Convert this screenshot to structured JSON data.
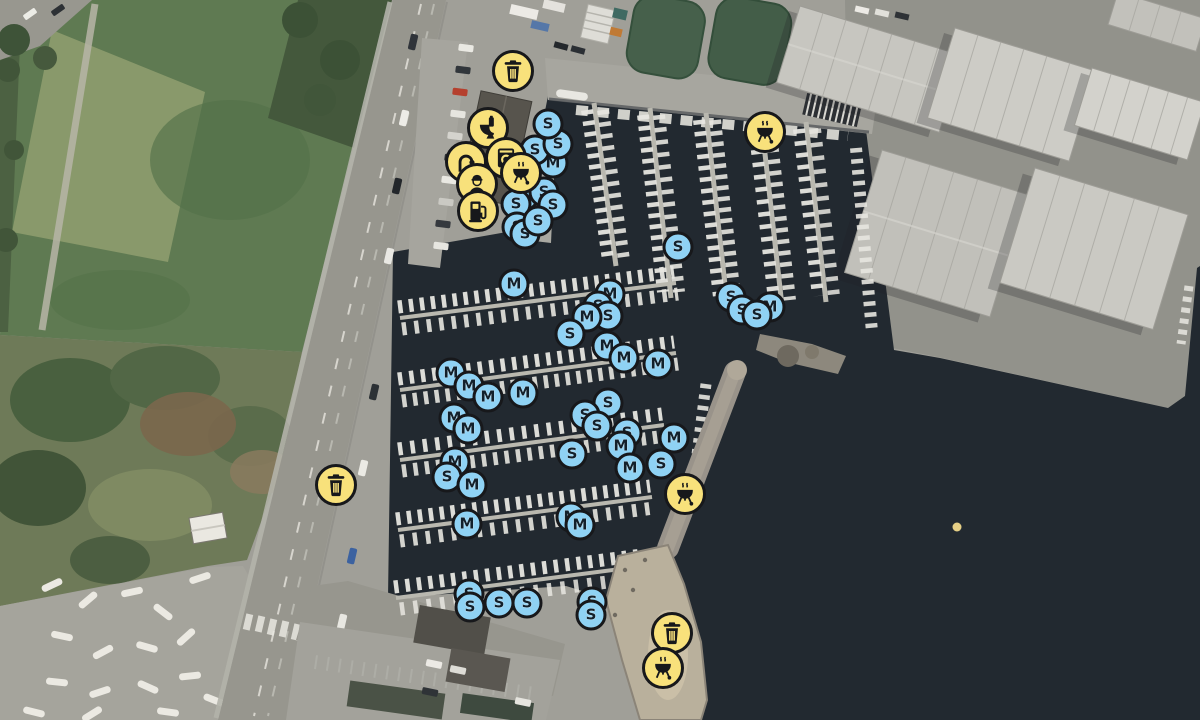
{
  "map": {
    "kind": "marina-aerial-map",
    "colors": {
      "facility_fill": "#f8e17b",
      "facility_outline": "#17181b",
      "berth_fill": "#8fd2f4",
      "berth_letter": "#12202b",
      "water": "#222930"
    },
    "facilities": [
      {
        "id": "waste-1",
        "icon": "trash-icon",
        "x": 513,
        "y": 71
      },
      {
        "id": "toilet-1",
        "icon": "toilet-icon",
        "x": 488,
        "y": 128
      },
      {
        "id": "shower-1",
        "icon": "shower-icon",
        "x": 466,
        "y": 162
      },
      {
        "id": "laundry-1",
        "icon": "washer-icon",
        "x": 506,
        "y": 158
      },
      {
        "id": "harbormaster-1",
        "icon": "person-icon",
        "x": 477,
        "y": 184
      },
      {
        "id": "grill-1",
        "icon": "grill-icon",
        "x": 521,
        "y": 173
      },
      {
        "id": "fuel-1",
        "icon": "fuel-icon",
        "x": 478,
        "y": 211
      },
      {
        "id": "grill-2",
        "icon": "grill-icon",
        "x": 765,
        "y": 132
      },
      {
        "id": "waste-2",
        "icon": "trash-icon",
        "x": 336,
        "y": 485
      },
      {
        "id": "grill-3",
        "icon": "grill-icon",
        "x": 685,
        "y": 494
      },
      {
        "id": "waste-3",
        "icon": "trash-icon",
        "x": 672,
        "y": 633
      },
      {
        "id": "grill-4",
        "icon": "grill-icon",
        "x": 663,
        "y": 668
      }
    ],
    "berths": [
      {
        "letter": "M",
        "x": 553,
        "y": 163
      },
      {
        "letter": "S",
        "x": 535,
        "y": 150
      },
      {
        "letter": "S",
        "x": 558,
        "y": 144
      },
      {
        "letter": "S",
        "x": 548,
        "y": 124
      },
      {
        "letter": "S",
        "x": 524,
        "y": 196
      },
      {
        "letter": "S",
        "x": 516,
        "y": 204
      },
      {
        "letter": "S",
        "x": 544,
        "y": 192
      },
      {
        "letter": "S",
        "x": 553,
        "y": 205
      },
      {
        "letter": "S",
        "x": 517,
        "y": 227
      },
      {
        "letter": "S",
        "x": 525,
        "y": 234
      },
      {
        "letter": "S",
        "x": 538,
        "y": 221
      },
      {
        "letter": "S",
        "x": 678,
        "y": 247
      },
      {
        "letter": "M",
        "x": 514,
        "y": 284
      },
      {
        "letter": "M",
        "x": 610,
        "y": 294
      },
      {
        "letter": "S",
        "x": 598,
        "y": 306
      },
      {
        "letter": "S",
        "x": 608,
        "y": 316
      },
      {
        "letter": "M",
        "x": 587,
        "y": 317
      },
      {
        "letter": "S",
        "x": 570,
        "y": 334
      },
      {
        "letter": "M",
        "x": 607,
        "y": 346
      },
      {
        "letter": "M",
        "x": 624,
        "y": 358
      },
      {
        "letter": "M",
        "x": 658,
        "y": 364
      },
      {
        "letter": "S",
        "x": 731,
        "y": 297
      },
      {
        "letter": "S",
        "x": 742,
        "y": 310
      },
      {
        "letter": "M",
        "x": 770,
        "y": 307
      },
      {
        "letter": "S",
        "x": 757,
        "y": 315
      },
      {
        "letter": "M",
        "x": 451,
        "y": 373
      },
      {
        "letter": "M",
        "x": 469,
        "y": 386
      },
      {
        "letter": "M",
        "x": 488,
        "y": 397
      },
      {
        "letter": "M",
        "x": 523,
        "y": 393
      },
      {
        "letter": "M",
        "x": 454,
        "y": 418
      },
      {
        "letter": "M",
        "x": 468,
        "y": 429
      },
      {
        "letter": "S",
        "x": 608,
        "y": 403
      },
      {
        "letter": "S",
        "x": 585,
        "y": 415
      },
      {
        "letter": "S",
        "x": 597,
        "y": 426
      },
      {
        "letter": "S",
        "x": 627,
        "y": 433
      },
      {
        "letter": "M",
        "x": 621,
        "y": 446
      },
      {
        "letter": "S",
        "x": 572,
        "y": 454
      },
      {
        "letter": "M",
        "x": 674,
        "y": 438
      },
      {
        "letter": "S",
        "x": 661,
        "y": 464
      },
      {
        "letter": "M",
        "x": 630,
        "y": 468
      },
      {
        "letter": "M",
        "x": 455,
        "y": 462
      },
      {
        "letter": "S",
        "x": 447,
        "y": 477
      },
      {
        "letter": "M",
        "x": 472,
        "y": 485
      },
      {
        "letter": "M",
        "x": 467,
        "y": 524
      },
      {
        "letter": "M",
        "x": 571,
        "y": 517
      },
      {
        "letter": "M",
        "x": 580,
        "y": 525
      },
      {
        "letter": "S",
        "x": 469,
        "y": 594
      },
      {
        "letter": "S",
        "x": 470,
        "y": 607
      },
      {
        "letter": "S",
        "x": 499,
        "y": 603
      },
      {
        "letter": "S",
        "x": 527,
        "y": 603
      },
      {
        "letter": "S",
        "x": 592,
        "y": 602
      },
      {
        "letter": "S",
        "x": 591,
        "y": 615
      }
    ]
  }
}
